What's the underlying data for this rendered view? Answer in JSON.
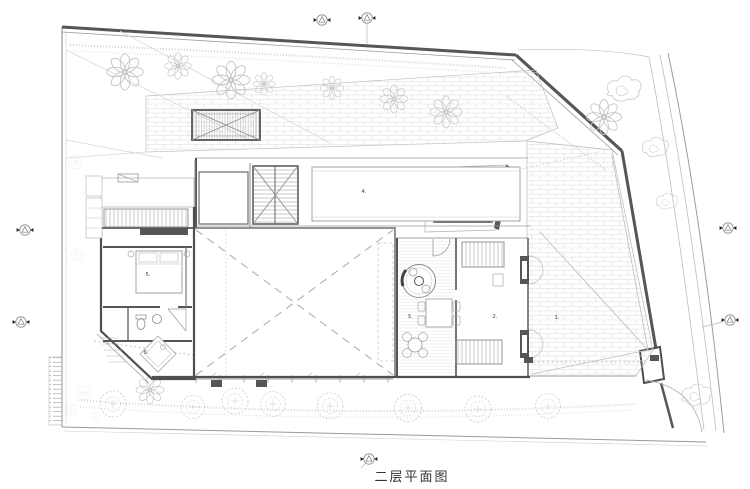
{
  "drawing": {
    "title": "二层平面图",
    "room_labels": {
      "r1": "1.",
      "r2": "2.",
      "r3": "3.",
      "r4": "4.",
      "r5": "5.",
      "r6": "6."
    }
  },
  "legend": {
    "marker_icon": "axis-survey-marker",
    "tree_icons": [
      "deciduous-tree",
      "round-shrub-tree",
      "cloud-tree"
    ]
  },
  "colors": {
    "background": "#ffffff",
    "wall_dark": "#4f4f4f",
    "line_light": "#c9c9c9",
    "line_mid": "#989898",
    "brick_line": "#dadada",
    "title_text": "#333333",
    "label_text": "#474747"
  }
}
